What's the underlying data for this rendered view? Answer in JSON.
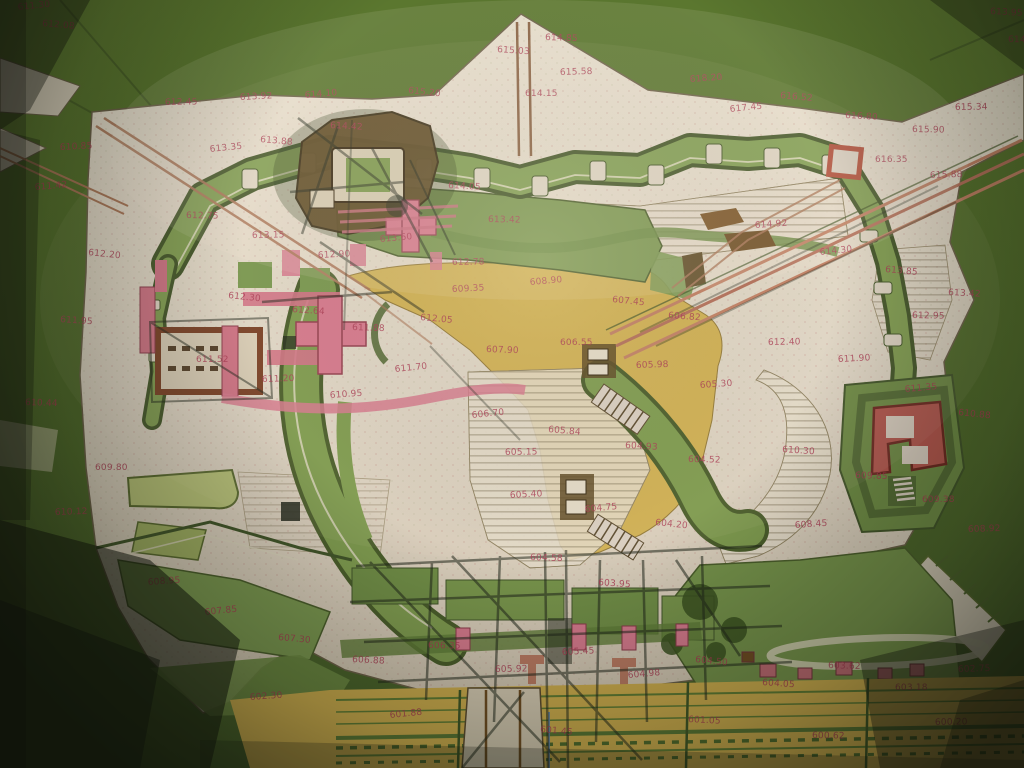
{
  "meta": {
    "kind": "photograph of a hand-drawn historical fortification plan",
    "media": "watercolor and ink on paper, red handwritten elevation figures",
    "no_printed_text": true
  },
  "palette": {
    "backdrop_green": "#55702e",
    "paper": "#ddd3c2",
    "paper_bright": "#e8e0cf",
    "terrain_green": "#74914a",
    "rampart_green": "#819d52",
    "dark_green_line": "#44572a",
    "yellow_ochre": "#cfae4e",
    "pink_building": "#d4798c",
    "crimson_rampart": "#b4574e",
    "brown_structure": "#5e4a24",
    "road_brown": "#a87456",
    "ink_overlay": "#20261a",
    "annotation_red": "#a93a52"
  },
  "annotations": {
    "color": "#a93a52",
    "items": [
      {
        "x": 18,
        "y": 10,
        "v": "611.30"
      },
      {
        "x": 42,
        "y": 26,
        "v": "612.08"
      },
      {
        "x": 990,
        "y": 14,
        "v": "613.95"
      },
      {
        "x": 1008,
        "y": 42,
        "v": "614.22"
      },
      {
        "x": 165,
        "y": 105,
        "v": "612.45"
      },
      {
        "x": 240,
        "y": 100,
        "v": "613.92"
      },
      {
        "x": 305,
        "y": 98,
        "v": "614.10"
      },
      {
        "x": 408,
        "y": 93,
        "v": "615.20"
      },
      {
        "x": 497,
        "y": 52,
        "v": "615.03"
      },
      {
        "x": 545,
        "y": 40,
        "v": "614.85"
      },
      {
        "x": 525,
        "y": 96,
        "v": "614.15"
      },
      {
        "x": 560,
        "y": 75,
        "v": "615.58"
      },
      {
        "x": 690,
        "y": 82,
        "v": "618.20"
      },
      {
        "x": 730,
        "y": 112,
        "v": "617.45"
      },
      {
        "x": 780,
        "y": 98,
        "v": "616.52"
      },
      {
        "x": 845,
        "y": 118,
        "v": "616.80"
      },
      {
        "x": 912,
        "y": 132,
        "v": "615.90"
      },
      {
        "x": 955,
        "y": 110,
        "v": "615.34"
      },
      {
        "x": 60,
        "y": 150,
        "v": "610.85"
      },
      {
        "x": 35,
        "y": 190,
        "v": "611.42"
      },
      {
        "x": 88,
        "y": 255,
        "v": "612.20"
      },
      {
        "x": 60,
        "y": 322,
        "v": "611.95"
      },
      {
        "x": 25,
        "y": 405,
        "v": "610.44"
      },
      {
        "x": 95,
        "y": 470,
        "v": "609.80"
      },
      {
        "x": 55,
        "y": 515,
        "v": "610.12"
      },
      {
        "x": 148,
        "y": 585,
        "v": "608.95"
      },
      {
        "x": 210,
        "y": 152,
        "v": "613.35"
      },
      {
        "x": 260,
        "y": 142,
        "v": "613.88"
      },
      {
        "x": 330,
        "y": 128,
        "v": "614.42"
      },
      {
        "x": 186,
        "y": 218,
        "v": "612.75"
      },
      {
        "x": 252,
        "y": 238,
        "v": "613.15"
      },
      {
        "x": 318,
        "y": 258,
        "v": "612.90"
      },
      {
        "x": 380,
        "y": 242,
        "v": "613.60"
      },
      {
        "x": 228,
        "y": 298,
        "v": "612.30"
      },
      {
        "x": 292,
        "y": 312,
        "v": "612.64"
      },
      {
        "x": 352,
        "y": 330,
        "v": "611.88"
      },
      {
        "x": 196,
        "y": 362,
        "v": "611.52"
      },
      {
        "x": 262,
        "y": 382,
        "v": "611.20"
      },
      {
        "x": 330,
        "y": 398,
        "v": "610.95"
      },
      {
        "x": 395,
        "y": 372,
        "v": "611.70"
      },
      {
        "x": 420,
        "y": 320,
        "v": "612.05"
      },
      {
        "x": 448,
        "y": 188,
        "v": "614.05"
      },
      {
        "x": 488,
        "y": 222,
        "v": "613.42"
      },
      {
        "x": 452,
        "y": 265,
        "v": "612.78"
      },
      {
        "x": 452,
        "y": 292,
        "v": "609.35"
      },
      {
        "x": 530,
        "y": 285,
        "v": "608.90"
      },
      {
        "x": 612,
        "y": 302,
        "v": "607.45"
      },
      {
        "x": 668,
        "y": 318,
        "v": "606.82"
      },
      {
        "x": 486,
        "y": 352,
        "v": "607.90"
      },
      {
        "x": 560,
        "y": 345,
        "v": "606.55"
      },
      {
        "x": 636,
        "y": 368,
        "v": "605.98"
      },
      {
        "x": 700,
        "y": 388,
        "v": "605.30"
      },
      {
        "x": 472,
        "y": 418,
        "v": "606.70"
      },
      {
        "x": 548,
        "y": 432,
        "v": "605.84"
      },
      {
        "x": 625,
        "y": 448,
        "v": "604.93"
      },
      {
        "x": 688,
        "y": 462,
        "v": "604.52"
      },
      {
        "x": 505,
        "y": 455,
        "v": "605.15"
      },
      {
        "x": 510,
        "y": 498,
        "v": "605.40"
      },
      {
        "x": 585,
        "y": 512,
        "v": "604.75"
      },
      {
        "x": 655,
        "y": 525,
        "v": "604.20"
      },
      {
        "x": 598,
        "y": 585,
        "v": "603.95"
      },
      {
        "x": 530,
        "y": 560,
        "v": "604.58"
      },
      {
        "x": 875,
        "y": 162,
        "v": "616.35"
      },
      {
        "x": 930,
        "y": 178,
        "v": "615.88"
      },
      {
        "x": 755,
        "y": 228,
        "v": "614.92"
      },
      {
        "x": 820,
        "y": 255,
        "v": "614.30"
      },
      {
        "x": 885,
        "y": 272,
        "v": "613.85"
      },
      {
        "x": 948,
        "y": 295,
        "v": "613.42"
      },
      {
        "x": 912,
        "y": 318,
        "v": "612.95"
      },
      {
        "x": 768,
        "y": 345,
        "v": "612.40"
      },
      {
        "x": 838,
        "y": 362,
        "v": "611.90"
      },
      {
        "x": 905,
        "y": 392,
        "v": "611.35"
      },
      {
        "x": 958,
        "y": 415,
        "v": "610.88"
      },
      {
        "x": 782,
        "y": 452,
        "v": "610.30"
      },
      {
        "x": 855,
        "y": 478,
        "v": "609.85"
      },
      {
        "x": 922,
        "y": 502,
        "v": "609.38"
      },
      {
        "x": 968,
        "y": 532,
        "v": "608.92"
      },
      {
        "x": 795,
        "y": 528,
        "v": "608.45"
      },
      {
        "x": 205,
        "y": 615,
        "v": "607.85"
      },
      {
        "x": 278,
        "y": 640,
        "v": "607.30"
      },
      {
        "x": 352,
        "y": 662,
        "v": "606.88"
      },
      {
        "x": 428,
        "y": 648,
        "v": "606.35"
      },
      {
        "x": 495,
        "y": 672,
        "v": "605.92"
      },
      {
        "x": 562,
        "y": 655,
        "v": "605.45"
      },
      {
        "x": 628,
        "y": 678,
        "v": "604.98"
      },
      {
        "x": 695,
        "y": 662,
        "v": "604.50"
      },
      {
        "x": 762,
        "y": 685,
        "v": "604.05"
      },
      {
        "x": 828,
        "y": 668,
        "v": "603.62"
      },
      {
        "x": 895,
        "y": 690,
        "v": "603.18"
      },
      {
        "x": 958,
        "y": 672,
        "v": "602.75"
      },
      {
        "x": 250,
        "y": 700,
        "v": "602.30"
      },
      {
        "x": 390,
        "y": 718,
        "v": "601.88"
      },
      {
        "x": 540,
        "y": 732,
        "v": "601.45"
      },
      {
        "x": 688,
        "y": 722,
        "v": "601.05"
      },
      {
        "x": 812,
        "y": 738,
        "v": "600.62"
      },
      {
        "x": 935,
        "y": 725,
        "v": "600.20"
      }
    ]
  }
}
